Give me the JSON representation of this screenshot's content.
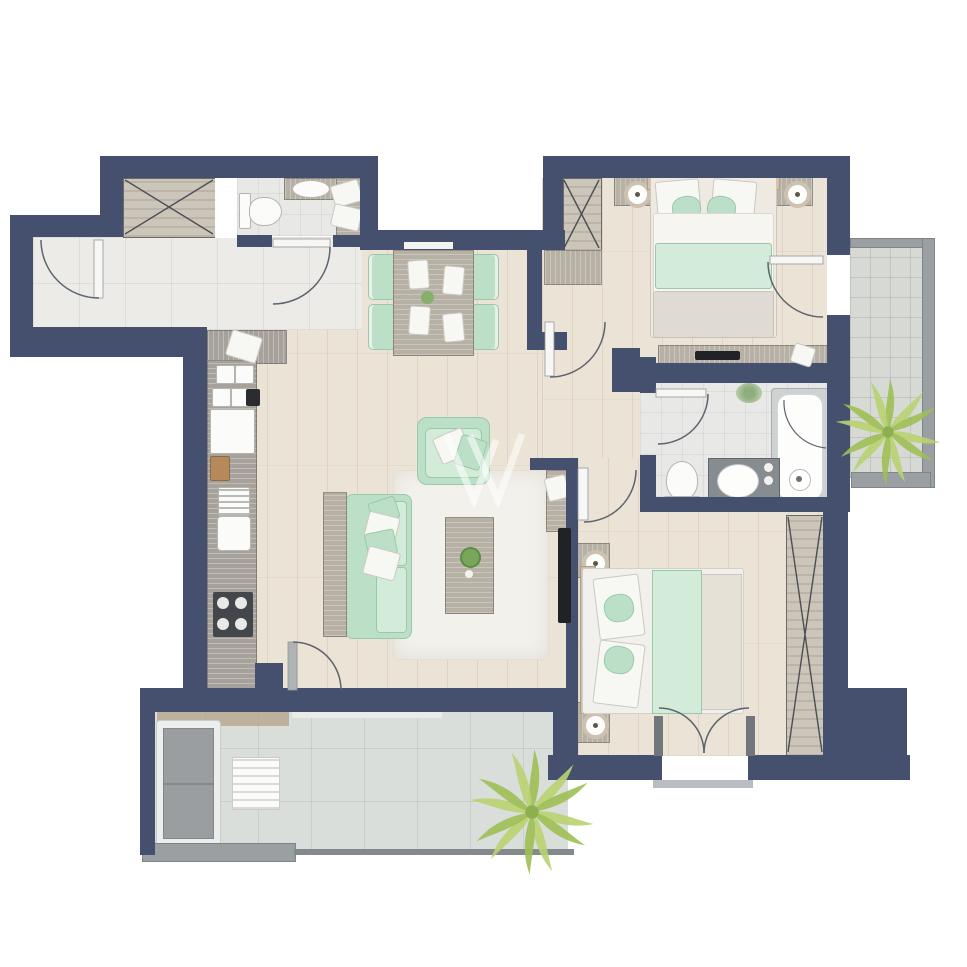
{
  "watermark": {
    "brand": "WELHOME",
    "logo_letter": "W"
  },
  "palette": {
    "wall": "#45506f",
    "wood_floor": "#ebe3d6",
    "hall_tile": "#ecebe8",
    "bath_tile": "#e8e9e7",
    "terrace_tile": "#dadeda",
    "balcony_tile": "#d7d9d5",
    "rug": "#f3f1eb",
    "green": "#bce0c7",
    "green_light": "#d3ecda",
    "green_dark": "#99c9aa",
    "furn_wood": "#b6b0a5",
    "counter_wood": "#a6a29b",
    "gray_rail": "#9aa0a2",
    "stove_dark": "#43464b",
    "tv_black": "#202226",
    "palm_green": "#b9d271",
    "palm_green_dark": "#9fbf55",
    "door_arc": "#5d646d",
    "terrace_sofa_gray": "#9b9ea0",
    "watermark_white": "rgba(255,255,255,0.62)"
  },
  "legend": {
    "rooms": [
      {
        "name": "entry-hall"
      },
      {
        "name": "entry-closet"
      },
      {
        "name": "bathroom-1"
      },
      {
        "name": "kitchen"
      },
      {
        "name": "living-dining-room"
      },
      {
        "name": "bedroom-1"
      },
      {
        "name": "bathroom-2"
      },
      {
        "name": "bedroom-2"
      },
      {
        "name": "terrace"
      },
      {
        "name": "balcony"
      }
    ],
    "furniture": [
      "wardrobe-x",
      "double-bed",
      "nightstand",
      "table-lamp",
      "dining-table",
      "dining-chair",
      "sofa",
      "armchair",
      "coffee-table",
      "tv",
      "tv-console",
      "kitchen-counter",
      "fridge",
      "sink",
      "stove",
      "toilet",
      "bathtub",
      "vanity-sink",
      "outdoor-sofa",
      "outdoor-table",
      "palm-plant"
    ]
  }
}
